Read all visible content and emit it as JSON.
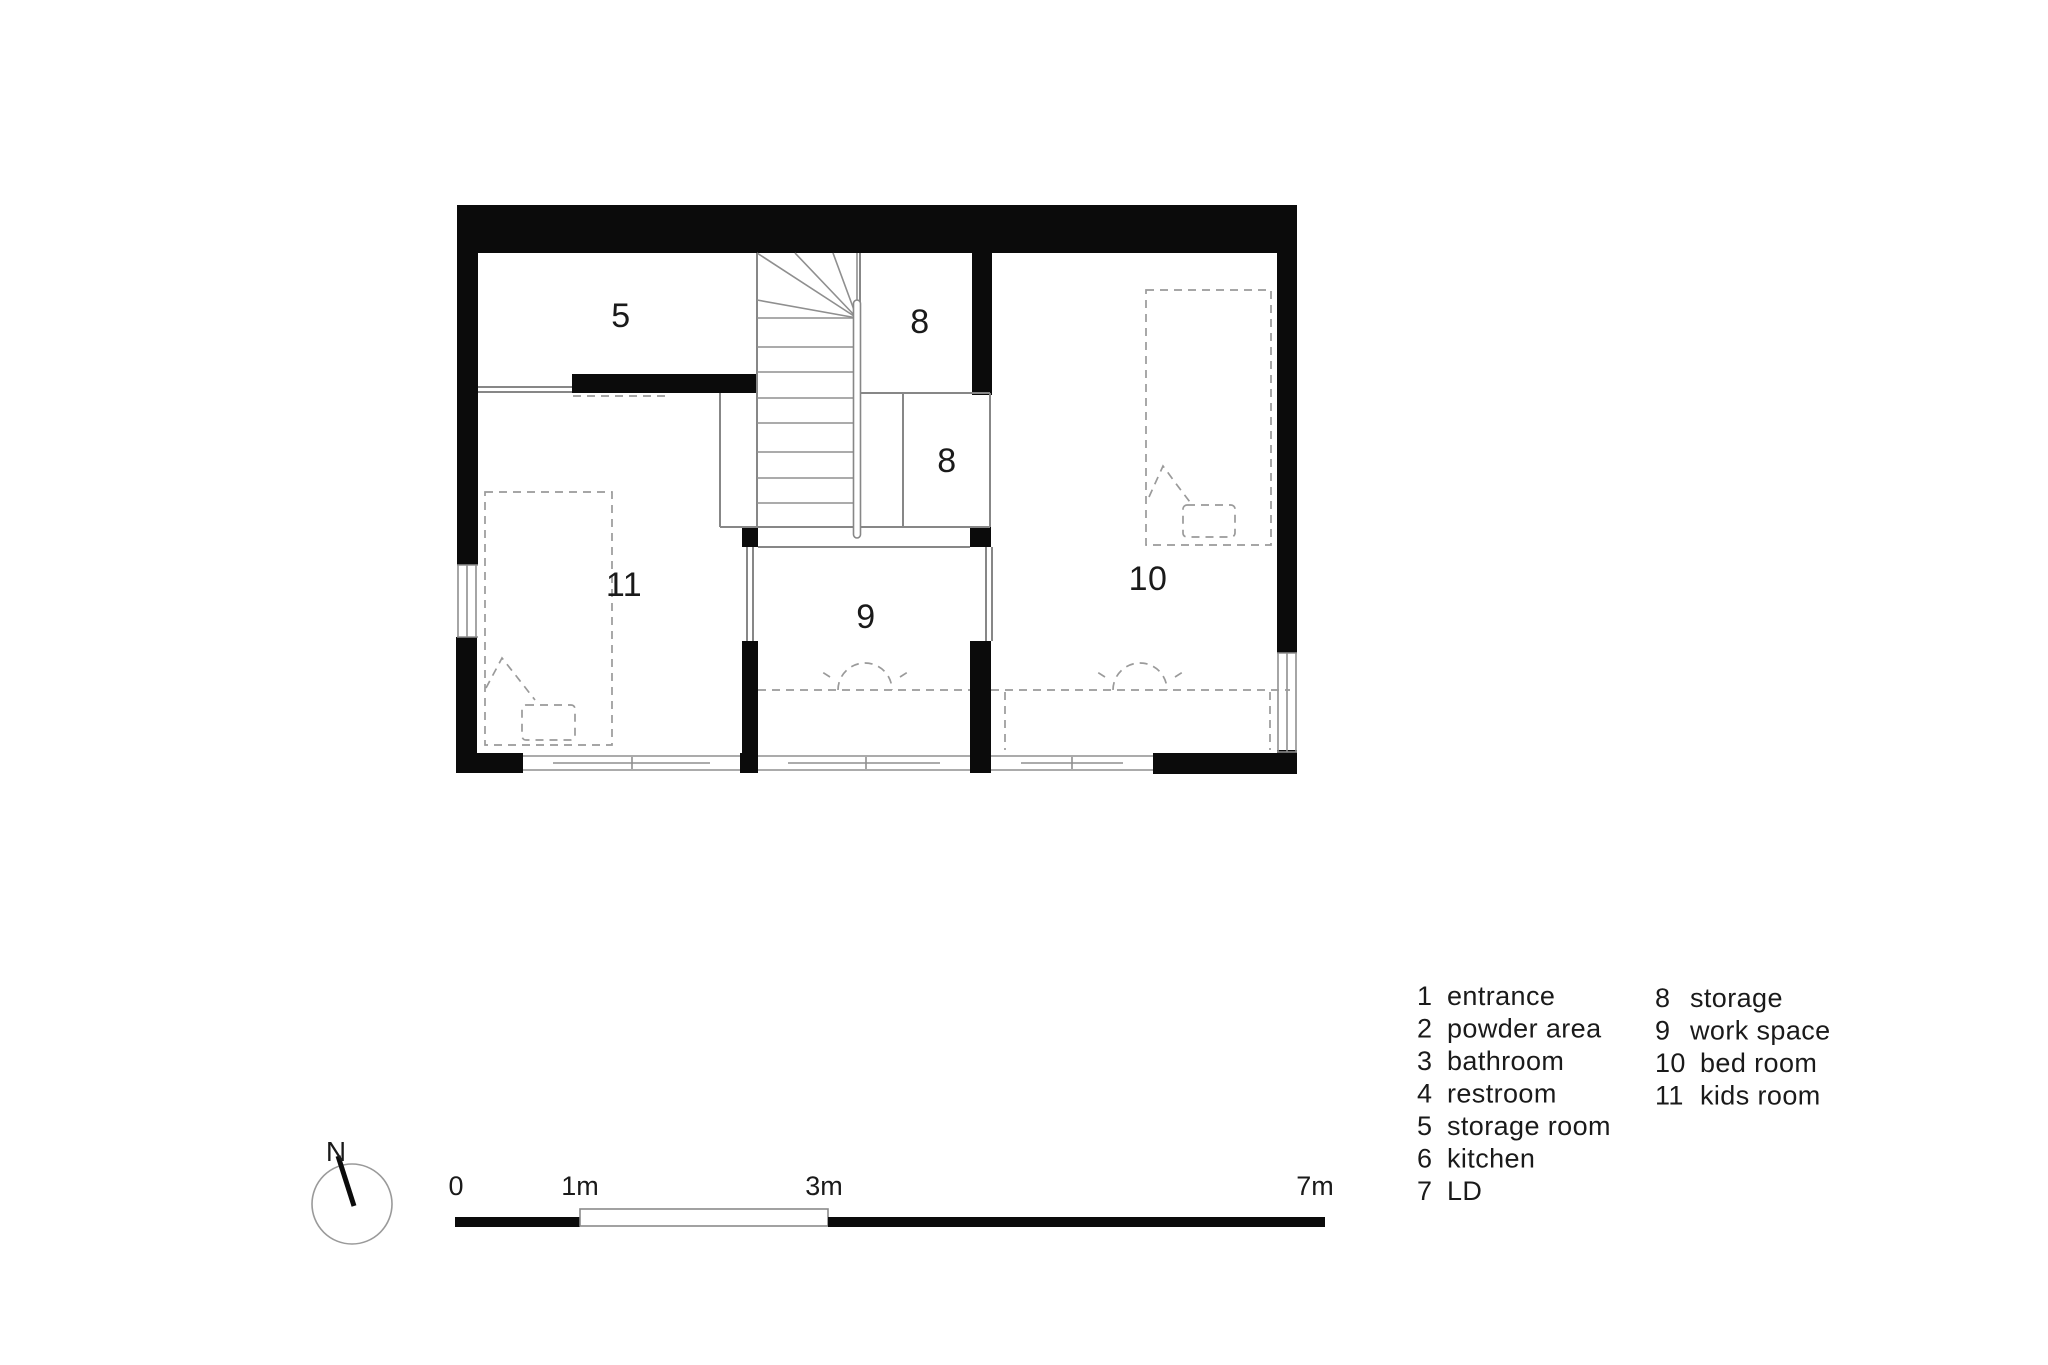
{
  "plan": {
    "rooms": [
      {
        "number": "5",
        "name": "storage room"
      },
      {
        "number": "8",
        "name": "storage"
      },
      {
        "number": "8",
        "name": "storage"
      },
      {
        "number": "11",
        "name": "kids room"
      },
      {
        "number": "9",
        "name": "work space"
      },
      {
        "number": "10",
        "name": "bed room"
      }
    ]
  },
  "compass": {
    "label": "N"
  },
  "scale_bar": {
    "labels": [
      "0",
      "1m",
      "3m",
      "7m"
    ]
  },
  "legend": {
    "columns": [
      {
        "items": [
          {
            "num": "1",
            "label": "entrance"
          },
          {
            "num": "2",
            "label": "powder area"
          },
          {
            "num": "3",
            "label": "bathroom"
          },
          {
            "num": "4",
            "label": "restroom"
          },
          {
            "num": "5",
            "label": "storage room"
          },
          {
            "num": "6",
            "label": "kitchen"
          },
          {
            "num": "7",
            "label": "LD"
          }
        ]
      },
      {
        "items": [
          {
            "num": "8",
            "label": "storage"
          },
          {
            "num": "9",
            "label": "work space"
          },
          {
            "num": "10",
            "label": "bed room"
          },
          {
            "num": "11",
            "label": "kids room"
          }
        ]
      }
    ]
  },
  "colors": {
    "wall": "#0b0b0b",
    "thin_line": "#878787",
    "dashed_line": "#9a9a9a",
    "text": "#1a1a1a"
  }
}
